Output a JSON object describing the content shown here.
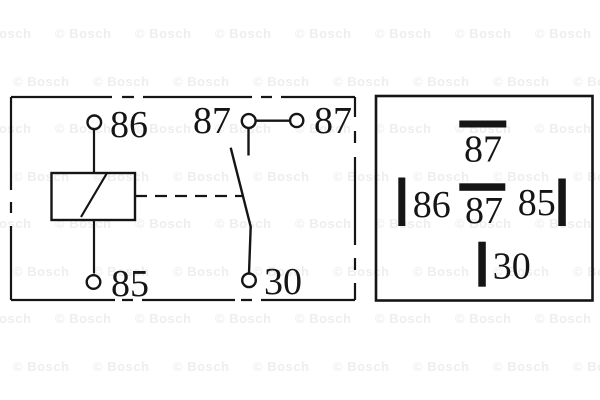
{
  "watermark": {
    "text": "© Bosch",
    "color": "#eeeeee"
  },
  "colors": {
    "line": "#151515",
    "background": "#ffffff"
  },
  "schematic": {
    "labels": {
      "t86": "86",
      "t87_left": "87",
      "t87_right": "87",
      "t85": "85",
      "t30": "30"
    }
  },
  "pinout": {
    "labels": {
      "top": "87",
      "left": "86",
      "middle": "87",
      "right": "85",
      "bottom": "30"
    }
  }
}
